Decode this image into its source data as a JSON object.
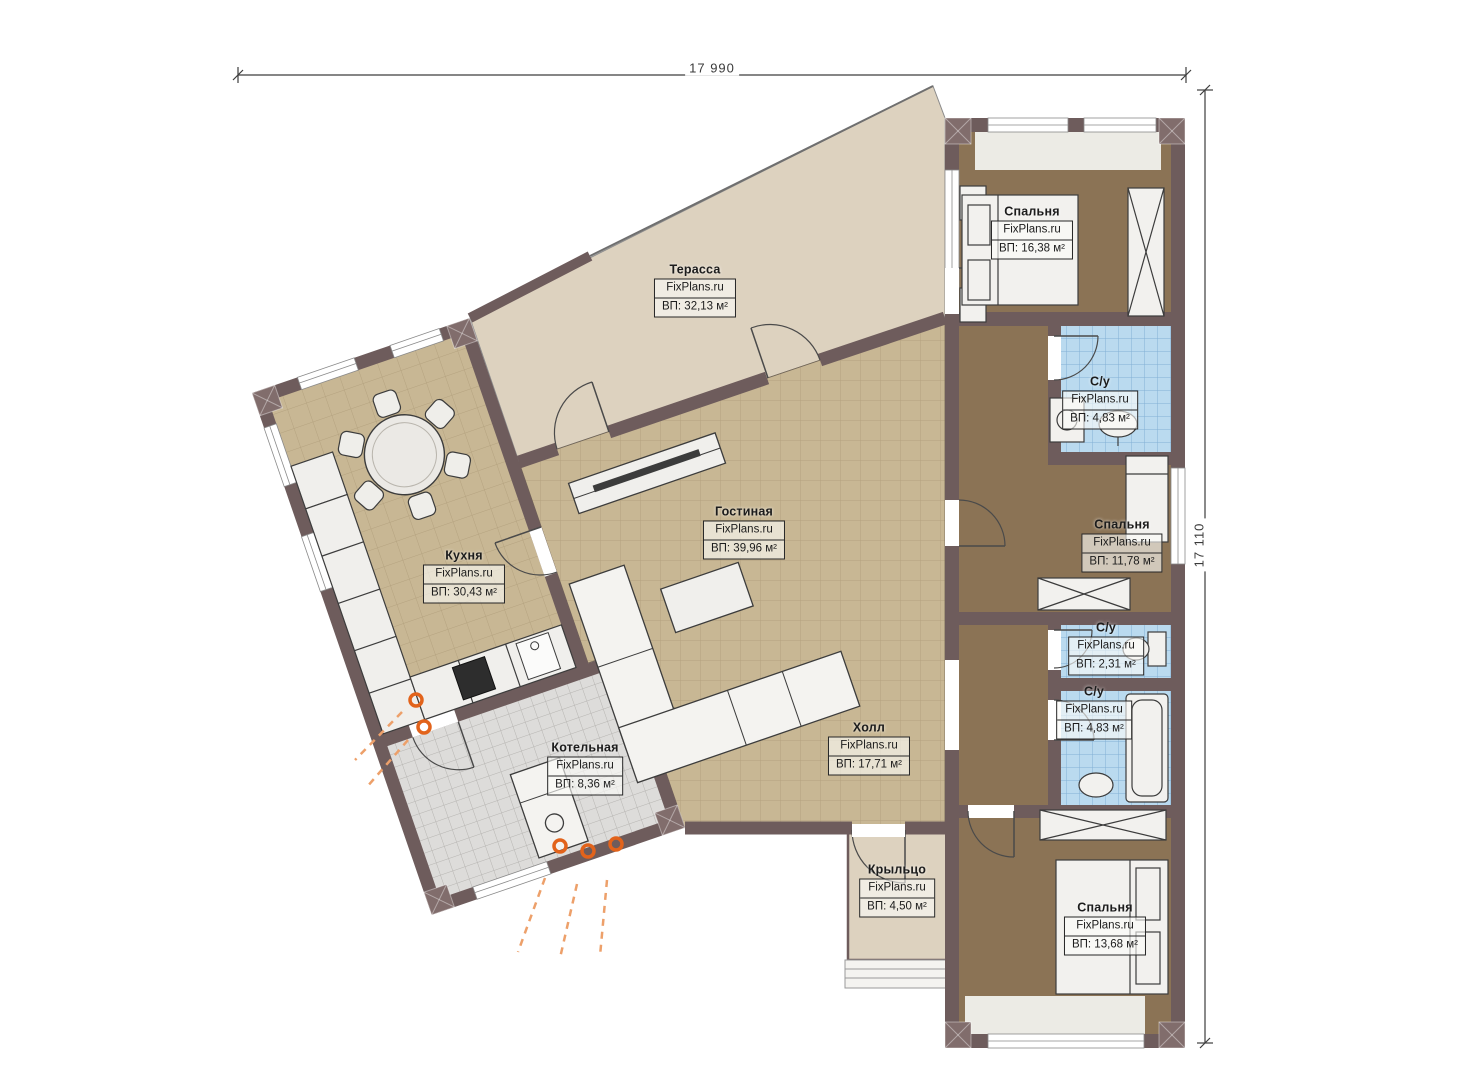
{
  "dimensions": {
    "top": "17 990",
    "right": "17 110"
  },
  "watermark": "FixPlans.ru",
  "rooms": [
    {
      "name": "Терасса",
      "area": "ВП: 32,13 м²"
    },
    {
      "name": "Спальня",
      "area": "ВП: 16,38 м²"
    },
    {
      "name": "С/у",
      "area": "ВП: 4,83 м²"
    },
    {
      "name": "Спальня",
      "area": "ВП: 11,78 м²"
    },
    {
      "name": "Кухня",
      "area": "ВП: 30,43 м²"
    },
    {
      "name": "Гостиная",
      "area": "ВП: 39,96 м²"
    },
    {
      "name": "Холл",
      "area": "ВП: 17,71 м²"
    },
    {
      "name": "Котельная",
      "area": "ВП: 8,36 м²"
    },
    {
      "name": "С/у",
      "area": "ВП: 2,31 м²"
    },
    {
      "name": "С/у",
      "area": "ВП: 4,83 м²"
    },
    {
      "name": "Крыльцо",
      "area": "ВП: 4,50 м²"
    },
    {
      "name": "Спальня",
      "area": "ВП: 13,68 м²"
    }
  ],
  "colors": {
    "wall": "#6e5c5c",
    "terrace_floor": "#ddd2bf",
    "tile_floor": "#c8b794",
    "bedroom_floor": "#8b7355",
    "bath_floor": "#badaef",
    "boiler_floor": "#dddcda",
    "flame_accent": "#e2631b"
  }
}
